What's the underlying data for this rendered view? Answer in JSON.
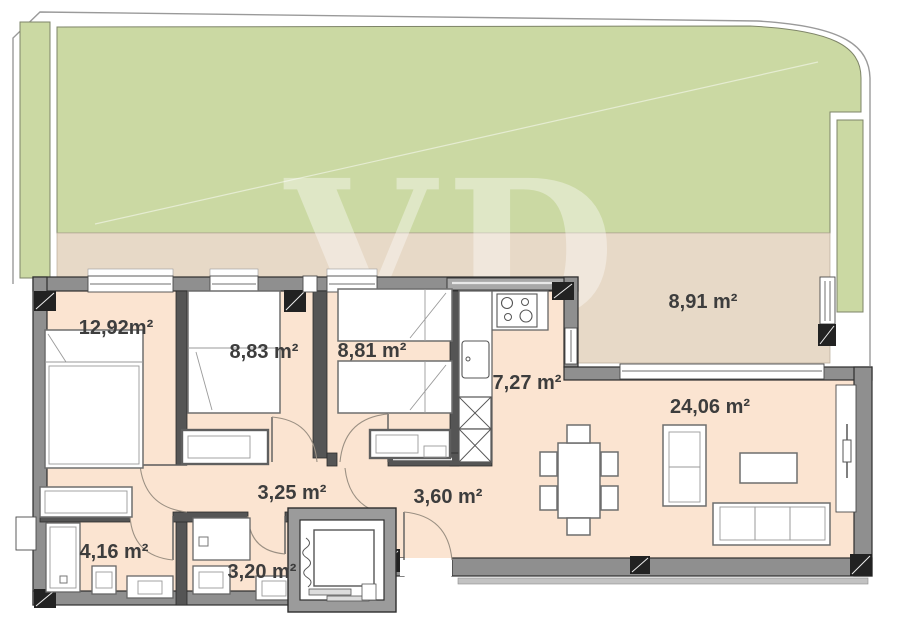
{
  "plan": {
    "title": "apartment-floor-plan",
    "watermark": "VD",
    "rooms": [
      {
        "id": "bedroom-1",
        "area_label": "12,92m²"
      },
      {
        "id": "bedroom-2",
        "area_label": "8,83 m²"
      },
      {
        "id": "bedroom-3",
        "area_label": "8,81 m²"
      },
      {
        "id": "kitchen",
        "area_label": "7,27 m²"
      },
      {
        "id": "terrace",
        "area_label": "8,91 m²"
      },
      {
        "id": "living-room",
        "area_label": "24,06 m²"
      },
      {
        "id": "hallway",
        "area_label": "3,25 m²"
      },
      {
        "id": "entrance-hall",
        "area_label": "3,60 m²"
      },
      {
        "id": "bathroom-1",
        "area_label": "4,16 m²"
      },
      {
        "id": "bathroom-2",
        "area_label": "3,20 m²"
      }
    ],
    "colors": {
      "garden": "#cbd9a3",
      "terrace": "#e7d9c7",
      "interior": "#fbe4d1",
      "wall": "#8f8f8f",
      "label_text": "#3d3d3d"
    }
  }
}
